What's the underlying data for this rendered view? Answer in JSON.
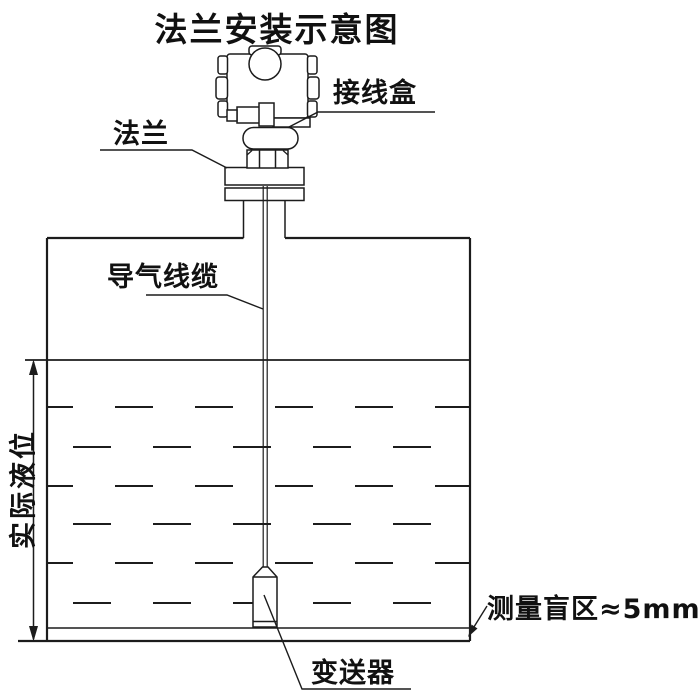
{
  "diagram": {
    "title": "法兰安装示意图",
    "labels": {
      "junction_box": "接线盒",
      "flange": "法兰",
      "air_cable": "导气线缆",
      "actual_level": "实际液位",
      "blind_zone": "测量盲区≈5mm",
      "transmitter": "变送器"
    },
    "colors": {
      "line": "#1c1c1c",
      "text": "#111111",
      "background": "#ffffff"
    }
  }
}
